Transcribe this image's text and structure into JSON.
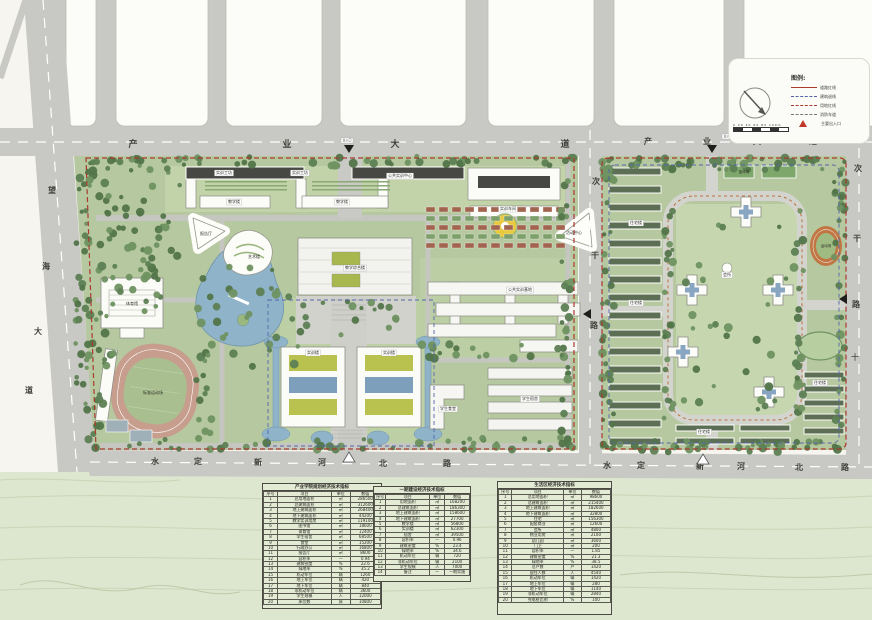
{
  "legend": {
    "title": "图例:",
    "entries": [
      {
        "label": "道路红线",
        "style": "ln-solid-red"
      },
      {
        "label": "建筑退线",
        "style": "ln-dash-blue"
      },
      {
        "label": "用地红线",
        "style": "ln-dash-red"
      },
      {
        "label": "消防车道",
        "style": "ln-dash-gray"
      },
      {
        "label": "主要出入口",
        "style": "tri"
      }
    ],
    "scale_text": "0  20  40  60  80  100m"
  },
  "road_labels": [
    {
      "name": "industry-avenue-west",
      "text": "产业大道",
      "size": 9,
      "pos": [
        [
          133,
          147
        ],
        [
          287,
          147
        ],
        [
          395,
          147
        ],
        [
          565,
          147
        ]
      ]
    },
    {
      "name": "industry-avenue-east",
      "text": "产业大道",
      "size": 8,
      "pos": [
        [
          648,
          144
        ],
        [
          707,
          144
        ],
        [
          757,
          144
        ],
        [
          813,
          144
        ]
      ]
    },
    {
      "name": "wanghai-avenue",
      "text": "望海大道",
      "size": 8,
      "pos": [
        [
          52,
          193
        ],
        [
          46,
          269
        ],
        [
          38,
          334
        ],
        [
          29,
          393
        ]
      ]
    },
    {
      "name": "secondary-road-middle",
      "text": "次干路",
      "size": 8,
      "pos": [
        [
          596,
          184
        ],
        [
          595,
          258
        ],
        [
          594,
          328
        ]
      ]
    },
    {
      "name": "secondary-road-east",
      "text": "次干路",
      "size": 8,
      "pos": [
        [
          858,
          171
        ],
        [
          857,
          241
        ],
        [
          856,
          307
        ]
      ]
    },
    {
      "name": "shuiding-xinhe-north-road-west",
      "text": "水定新河北路",
      "size": 8,
      "pos": [
        [
          155,
          464
        ],
        [
          198,
          464
        ],
        [
          258,
          465
        ],
        [
          322,
          465
        ],
        [
          383,
          466
        ],
        [
          447,
          466
        ]
      ]
    },
    {
      "name": "shuiding-xinhe-north-road-east",
      "text": "水定新河北路",
      "size": 8,
      "pos": [
        [
          607,
          468
        ],
        [
          641,
          468
        ],
        [
          700,
          469
        ],
        [
          741,
          469
        ],
        [
          799,
          470
        ],
        [
          845,
          470
        ]
      ]
    }
  ],
  "map_labels": [
    {
      "t": "主入口",
      "x": 347,
      "y": 141,
      "s": 3,
      "bg": true
    },
    {
      "t": "主入口",
      "x": 728,
      "y": 137,
      "s": 3,
      "bg": true
    },
    {
      "t": "十",
      "x": 855,
      "y": 360,
      "s": 8
    },
    {
      "t": "实训工坊",
      "x": 224,
      "y": 174,
      "s": 4,
      "bg": true
    },
    {
      "t": "实训工坊",
      "x": 300,
      "y": 174,
      "s": 4,
      "bg": true
    },
    {
      "t": "公共实训中心",
      "x": 400,
      "y": 177,
      "s": 4,
      "bg": true
    },
    {
      "t": "教学楼",
      "x": 234,
      "y": 203,
      "s": 4,
      "bg": true
    },
    {
      "t": "教学楼",
      "x": 342,
      "y": 203,
      "s": 4,
      "bg": true
    },
    {
      "t": "实训车间",
      "x": 508,
      "y": 210,
      "s": 4,
      "bg": true
    },
    {
      "t": "报告厅",
      "x": 206,
      "y": 235,
      "s": 4
    },
    {
      "t": "艺术楼",
      "x": 254,
      "y": 258,
      "s": 4
    },
    {
      "t": "教学综合楼",
      "x": 355,
      "y": 269,
      "s": 4,
      "bg": true
    },
    {
      "t": "活动中心",
      "x": 574,
      "y": 234,
      "s": 4
    },
    {
      "t": "体育馆",
      "x": 132,
      "y": 305,
      "s": 4
    },
    {
      "t": "标准运动场",
      "x": 153,
      "y": 394,
      "s": 4
    },
    {
      "t": "公共实训基地",
      "x": 520,
      "y": 291,
      "s": 4,
      "bg": true
    },
    {
      "t": "实训楼",
      "x": 313,
      "y": 354,
      "s": 4,
      "bg": true
    },
    {
      "t": "实训楼",
      "x": 389,
      "y": 354,
      "s": 4,
      "bg": true
    },
    {
      "t": "学生食堂",
      "x": 448,
      "y": 410,
      "s": 4,
      "bg": true
    },
    {
      "t": "学生宿舍",
      "x": 530,
      "y": 400,
      "s": 4,
      "bg": true
    },
    {
      "t": "住宅楼",
      "x": 636,
      "y": 224,
      "s": 4,
      "bg": true
    },
    {
      "t": "住宅楼",
      "x": 636,
      "y": 304,
      "s": 4,
      "bg": true
    },
    {
      "t": "会所",
      "x": 727,
      "y": 276,
      "s": 4,
      "bg": true
    },
    {
      "t": "住宅楼",
      "x": 704,
      "y": 433,
      "s": 4,
      "bg": true
    },
    {
      "t": "住宅楼",
      "x": 820,
      "y": 384,
      "s": 4,
      "bg": true
    },
    {
      "t": "篮球场",
      "x": 744,
      "y": 173,
      "s": 3.5
    },
    {
      "t": "运动场",
      "x": 826,
      "y": 247,
      "s": 3.5
    }
  ],
  "markers": [
    {
      "shape": "tri-down",
      "x": 349,
      "y": 149,
      "fill": "#1e1e1c"
    },
    {
      "shape": "tri-down",
      "x": 712,
      "y": 149,
      "fill": "#1e1e1c"
    },
    {
      "shape": "tri-left",
      "x": 588,
      "y": 314,
      "fill": "#1e1e1c"
    },
    {
      "shape": "tri-left",
      "x": 844,
      "y": 299,
      "fill": "#1e1e1c"
    },
    {
      "shape": "tri-up",
      "x": 703,
      "y": 459,
      "fill": "#ffffff",
      "stroke": "#555555"
    },
    {
      "shape": "tri-up",
      "x": 349,
      "y": 457,
      "fill": "#ffffff",
      "stroke": "#555555"
    }
  ],
  "tables": [
    {
      "name": "campus-indicators-table",
      "title": "产业学院规划经济技术指标",
      "x": 262,
      "y": 483,
      "w": 120,
      "h": 126,
      "header": [
        "序号",
        "项目",
        "单位",
        "数值"
      ],
      "rows": [
        [
          "1",
          "总用地面积",
          "㎡",
          "286500"
        ],
        [
          "2",
          "总建筑面积",
          "㎡",
          "312600"
        ],
        [
          "3",
          "地上建筑面积",
          "㎡",
          "268400"
        ],
        [
          "4",
          "地下建筑面积",
          "㎡",
          "44200"
        ],
        [
          "5",
          "教学实训用房",
          "㎡",
          "119100"
        ],
        [
          "6",
          "图书馆",
          "㎡",
          "18600"
        ],
        [
          "7",
          "体育馆",
          "㎡",
          "12400"
        ],
        [
          "8",
          "学生宿舍",
          "㎡",
          "68500"
        ],
        [
          "9",
          "食堂",
          "㎡",
          "15200"
        ],
        [
          "10",
          "行政办公",
          "㎡",
          "16800"
        ],
        [
          "11",
          "报告厅",
          "㎡",
          "8600"
        ],
        [
          "12",
          "容积率",
          "—",
          "0.94"
        ],
        [
          "13",
          "建筑密度",
          "%",
          "22.6"
        ],
        [
          "14",
          "绿地率",
          "%",
          "35.2"
        ],
        [
          "15",
          "机动车位",
          "辆",
          "1260"
        ],
        [
          "16",
          "地上车位",
          "辆",
          "420"
        ],
        [
          "17",
          "地下车位",
          "辆",
          "840"
        ],
        [
          "18",
          "非机动车位",
          "辆",
          "3600"
        ],
        [
          "19",
          "学生规模",
          "人",
          "12000"
        ],
        [
          "20",
          "床位数",
          "床",
          "10800"
        ]
      ]
    },
    {
      "name": "phase-one-indicators-table",
      "title": "一期建设经济技术指标",
      "x": 373,
      "y": 486,
      "w": 98,
      "h": 96,
      "header": [
        "序号",
        "项目",
        "单位",
        "数值"
      ],
      "rows": [
        [
          "1",
          "用地面积",
          "㎡",
          "168200"
        ],
        [
          "2",
          "总建筑面积",
          "㎡",
          "186300"
        ],
        [
          "3",
          "地上建筑面积",
          "㎡",
          "158600"
        ],
        [
          "4",
          "地下建筑面积",
          "㎡",
          "27700"
        ],
        [
          "5",
          "教学楼",
          "㎡",
          "56800"
        ],
        [
          "6",
          "实训楼",
          "㎡",
          "62300"
        ],
        [
          "7",
          "宿舍",
          "㎡",
          "39500"
        ],
        [
          "8",
          "容积率",
          "—",
          "0.96"
        ],
        [
          "9",
          "建筑密度",
          "%",
          "23.4"
        ],
        [
          "10",
          "绿地率",
          "%",
          "34.6"
        ],
        [
          "11",
          "机动车位",
          "辆",
          "720"
        ],
        [
          "12",
          "非机动车位",
          "辆",
          "2100"
        ],
        [
          "13",
          "学生规模",
          "人",
          "7000"
        ],
        [
          "14",
          "备注",
          "—",
          "一期实施"
        ]
      ]
    },
    {
      "name": "residential-indicators-table",
      "title": "生活区经济技术指标",
      "x": 497,
      "y": 481,
      "w": 115,
      "h": 134,
      "header": [
        "序号",
        "项目",
        "单位",
        "数值"
      ],
      "rows": [
        [
          "1",
          "总用地面积",
          "㎡",
          "98600"
        ],
        [
          "2",
          "总建筑面积",
          "㎡",
          "215400"
        ],
        [
          "3",
          "地上建筑面积",
          "㎡",
          "182600"
        ],
        [
          "4",
          "地下建筑面积",
          "㎡",
          "32800"
        ],
        [
          "5",
          "住宅",
          "㎡",
          "156300"
        ],
        [
          "6",
          "配套商业",
          "㎡",
          "12600"
        ],
        [
          "7",
          "会所",
          "㎡",
          "4800"
        ],
        [
          "8",
          "物业用房",
          "㎡",
          "2100"
        ],
        [
          "9",
          "幼儿园",
          "㎡",
          "3600"
        ],
        [
          "10",
          "门卫",
          "㎡",
          "200"
        ],
        [
          "11",
          "容积率",
          "—",
          "1.85"
        ],
        [
          "12",
          "建筑密度",
          "%",
          "21.3"
        ],
        [
          "13",
          "绿地率",
          "%",
          "38.5"
        ],
        [
          "14",
          "总户数",
          "户",
          "1420"
        ],
        [
          "15",
          "居住人数",
          "人",
          "4540"
        ],
        [
          "16",
          "机动车位",
          "辆",
          "1420"
        ],
        [
          "17",
          "地上车位",
          "辆",
          "280"
        ],
        [
          "18",
          "地下车位",
          "辆",
          "1140"
        ],
        [
          "19",
          "非机动车位",
          "辆",
          "2840"
        ],
        [
          "20",
          "充电桩比例",
          "%",
          "100"
        ]
      ]
    }
  ]
}
